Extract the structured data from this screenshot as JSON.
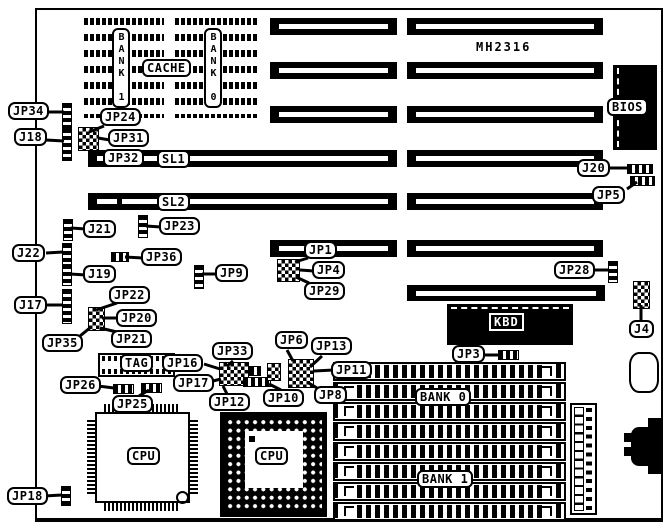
{
  "model": "MH2316",
  "chips": {
    "cache": "CACHE",
    "tag": "TAG",
    "bios": "BIOS",
    "kbd": "KBD",
    "cpu_qfp": "CPU",
    "cpu_pga": "CPU",
    "dip_bank1": "BANK 1",
    "dip_bank0": "BANK 0",
    "simm_bank0": "BANK 0",
    "simm_bank1": "BANK 1"
  },
  "slots": {
    "sl1": "SL1",
    "sl2": "SL2",
    "jp32": "JP32"
  },
  "callouts": {
    "jp34": "JP34",
    "j18": "J18",
    "jp24": "JP24",
    "jp31": "JP31",
    "j21": "J21",
    "jp23": "JP23",
    "j22": "J22",
    "jp36": "JP36",
    "j19": "J19",
    "jp9": "JP9",
    "j17": "J17",
    "jp22": "JP22",
    "jp20": "JP20",
    "jp21": "JP21",
    "jp35": "JP35",
    "jp16": "JP16",
    "jp33": "JP33",
    "jp26": "JP26",
    "jp17": "JP17",
    "jp25": "JP25",
    "jp12": "JP12",
    "jp10": "JP10",
    "jp18": "JP18",
    "jp1": "JP1",
    "jp4": "JP4",
    "jp29": "JP29",
    "jp6": "JP6",
    "jp13": "JP13",
    "jp11": "JP11",
    "jp8": "JP8",
    "jp3": "JP3",
    "j20": "J20",
    "jp5": "JP5",
    "jp28": "JP28",
    "j4": "J4"
  },
  "colors": {
    "ink": "#000000",
    "background": "#ffffff"
  }
}
